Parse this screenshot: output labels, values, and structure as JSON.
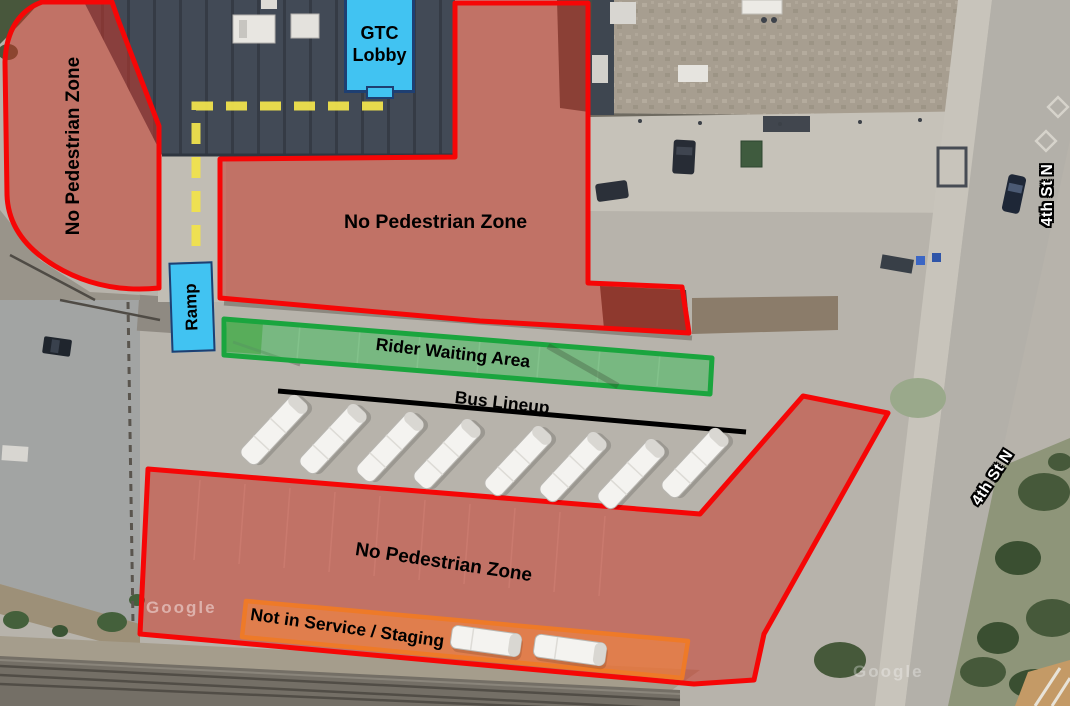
{
  "map": {
    "description": "Aerial transit center wayfinding map with overlay zones",
    "watermark": {
      "text": "Google",
      "occurrences": 2
    },
    "zones": {
      "left_no_pedestrian": {
        "label": "No Pedestrian Zone"
      },
      "center_no_pedestrian": {
        "label": "No Pedestrian Zone"
      },
      "south_no_pedestrian": {
        "label": "No Pedestrian Zone"
      },
      "rider_waiting_area": {
        "label": "Rider Waiting Area"
      },
      "staging_area": {
        "label": "Not in Service / Staging",
        "bus_count": 2
      }
    },
    "bus_lineup": {
      "label": "Bus Lineup",
      "bus_count": 8
    },
    "markers": {
      "gtc_lobby": {
        "label": "GTC Lobby"
      },
      "ramp": {
        "label": "Ramp"
      }
    },
    "walking_path": {
      "style": "dashed",
      "color": "#f0e14d"
    },
    "streets": {
      "north_label": "4th St N",
      "south_label": "4th St N"
    },
    "colors": {
      "no_pedestrian_border": "#f60606",
      "no_pedestrian_fill": "#cc3527",
      "waiting_border": "#1aa53e",
      "waiting_fill": "#45bb5e",
      "staging_border": "#ee7a28",
      "staging_fill": "#f5873c",
      "marker_fill": "#41c3f2",
      "marker_border": "#1e3f72",
      "lineup_line": "#000000"
    }
  }
}
